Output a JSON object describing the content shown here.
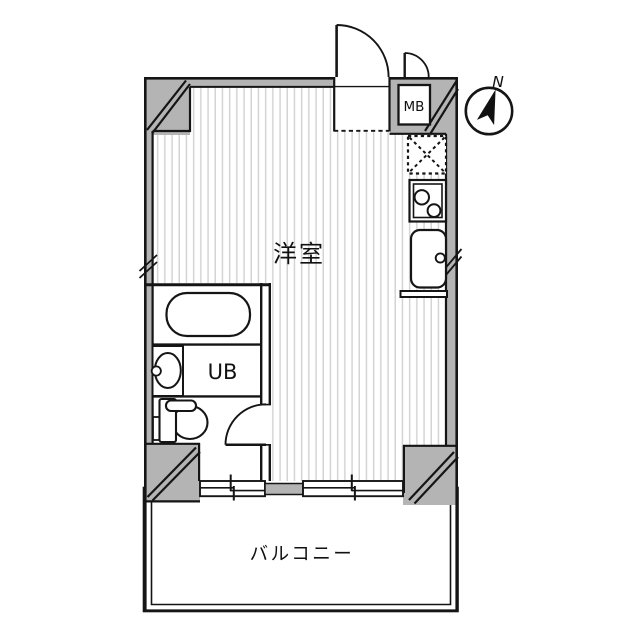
{
  "floorplan": {
    "labels": {
      "main_room": "洋室",
      "unit_bath": "UB",
      "meter_box": "MB",
      "balcony": "バルコニー",
      "compass_north": "N"
    },
    "fixtures": [
      "entrance-door",
      "meter-box-door",
      "bathroom-door",
      "bathtub",
      "vanity-sink",
      "toilet",
      "refrigerator-space",
      "gas-stove",
      "kitchen-sink",
      "counter-edge",
      "sliding-window-left",
      "sliding-window-right",
      "compass-north-icon"
    ],
    "colors": {
      "wall_fill": "#b4b4b4",
      "line": "#151515",
      "floor_stripe": "#d4d4d4",
      "background": "#ffffff"
    }
  }
}
